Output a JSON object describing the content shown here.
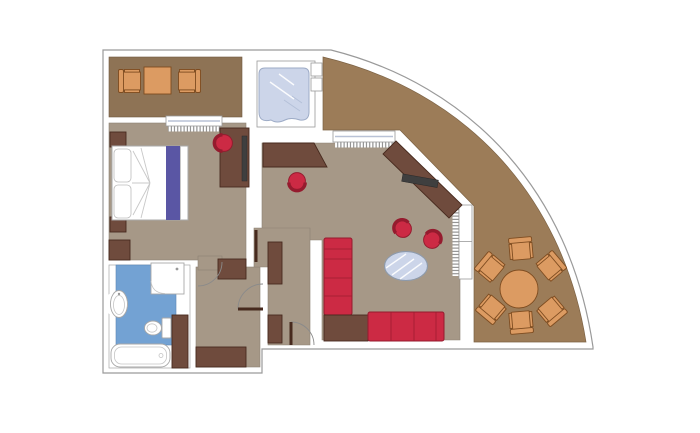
{
  "meta": {
    "title": "Hotel suite floor plan",
    "description": "Top-down architectural floor plan of a suite with curved balcony"
  },
  "canvas": {
    "width": 700,
    "height": 433
  },
  "colors": {
    "wall-stroke": "#9a9a9a",
    "floor": "#a69887",
    "terrace": "#8e7355",
    "balcony": "#9c7c58",
    "blue-floor": "#73a2d3",
    "wood": "#6f4b3d",
    "wood-dark": "#472a1e",
    "red": "#cc2a44",
    "red-dark": "#951b2e",
    "orange": "#dc9b62",
    "orange-dark": "#7e4c20",
    "glass": "#ccd5e9",
    "purple": "#5a56a4",
    "tv": "#3f3f3f",
    "fixture-stroke": "#a8a8a8"
  },
  "rooms": [
    {
      "id": "terrace",
      "label": "Terrace sitting area",
      "furniture": [
        "armchair",
        "side table",
        "armchair"
      ]
    },
    {
      "id": "spa-niche",
      "label": "Whirlpool niche",
      "furniture": [
        "whirlpool glass tub"
      ]
    },
    {
      "id": "bedroom",
      "label": "Bedroom",
      "furniture": [
        "double bed",
        "pillows",
        "nightstand",
        "nightstand",
        "dresser",
        "desk with tv",
        "desk chair",
        "closet",
        "window"
      ]
    },
    {
      "id": "bathroom",
      "label": "Bathroom",
      "furniture": [
        "washbasin",
        "shower",
        "toilet",
        "bathtub",
        "tall cabinet"
      ]
    },
    {
      "id": "hall",
      "label": "Entrance hall",
      "furniture": [
        "wardrobe",
        "cabinet",
        "bottom closet",
        "entry door",
        "interior doors"
      ]
    },
    {
      "id": "living-room",
      "label": "Living room",
      "furniture": [
        "console table",
        "stool",
        "tv sideboard",
        "tv",
        "armchair",
        "armchair",
        "glass coffee table",
        "corner sofa",
        "corner table",
        "sliding door",
        "window"
      ]
    },
    {
      "id": "balcony",
      "label": "Curved balcony",
      "furniture": [
        "round dining table",
        "dining chair",
        "dining chair",
        "dining chair",
        "dining chair",
        "dining chair",
        "dining chair"
      ]
    }
  ]
}
